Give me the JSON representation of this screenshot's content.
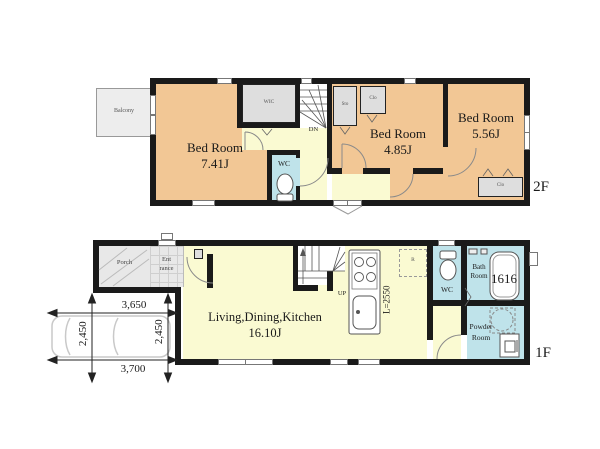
{
  "colors": {
    "tan": "#f2c795",
    "yellow": "#fafad2",
    "cyan": "#bfe3ea",
    "gray": "#e8e8e8",
    "wall": "#1a1a1a"
  },
  "floor2": {
    "label": "2F",
    "balcony": "Balcony",
    "bed1": {
      "name": "Bed Room",
      "size": "7.41J"
    },
    "bed2": {
      "name": "Bed Room",
      "size": "4.85J"
    },
    "bed3": {
      "name": "Bed Room",
      "size": "5.56J"
    },
    "wic": "WIC",
    "sto": "Sto",
    "clo_top": "Clo",
    "clo_right": "Clo",
    "wc": "WC",
    "stairs": "DN"
  },
  "floor1": {
    "label": "1F",
    "porch": "Porch",
    "entrance": {
      "line1": "Ent",
      "line2": "rance"
    },
    "ldk": {
      "name": "Living,Dining,Kitchen",
      "size": "16.10J"
    },
    "kitchen_counter": "L=2550",
    "fridge": "R",
    "stairs": "UP",
    "wc": "WC",
    "bath": {
      "line1": "Bath",
      "line2": "Room",
      "size": "1616"
    },
    "powder": {
      "line1": "Powder",
      "line2": "Room"
    }
  },
  "dimensions": {
    "top_width": "3,650",
    "bottom_width": "3,700",
    "left_height": "2,450",
    "right_height": "2,450"
  }
}
